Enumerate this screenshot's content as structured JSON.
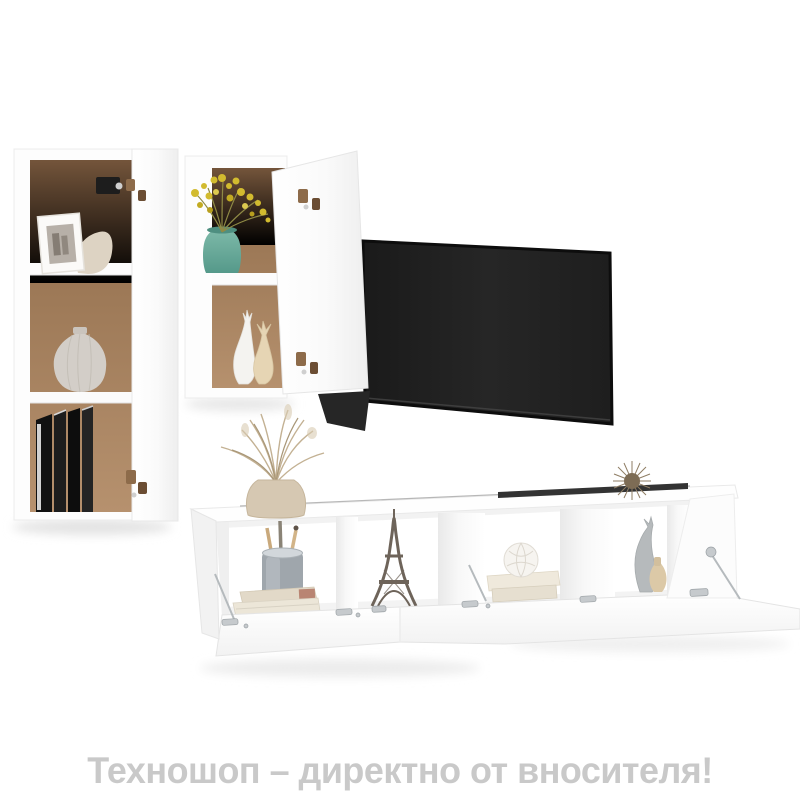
{
  "caption": {
    "text": "Техношоп – директно от вносителя!",
    "color": "#c9c9c9"
  },
  "scene": {
    "background": "#ffffff",
    "objects": [
      {
        "name": "tall-wall-cabinet",
        "color": "#ffffff",
        "interior": "#a5815f",
        "contents": [
          "photo-frame",
          "ribbed-vase",
          "black-books"
        ]
      },
      {
        "name": "short-wall-cabinet",
        "color": "#ffffff",
        "interior": "#a5815f",
        "contents": [
          "teal-vase-with-yellow-flowers",
          "deer-figurines"
        ]
      },
      {
        "name": "tv-screen",
        "color": "#202020"
      },
      {
        "name": "tv-stand-4-bays",
        "color": "#ffffff",
        "contents": [
          "concrete-pen-cup",
          "stacked-books",
          "eiffel-tower-figurine",
          "shell-ornament",
          "cat-figurine",
          "mini-vase"
        ]
      },
      {
        "name": "dried-grass-vase",
        "color": "#d9c8ad"
      },
      {
        "name": "sputnik-ornament",
        "color": "#8f7d64"
      }
    ]
  },
  "palette": {
    "wood": "#a5815f",
    "tv": "#202020",
    "teal": "#68ae9d",
    "flower": "#d2bb2f",
    "concrete": "#9fa6ac",
    "caption_gray": "#c9c9c9",
    "metal": "#b9bdc0",
    "bronze": "#8d6b4a"
  }
}
